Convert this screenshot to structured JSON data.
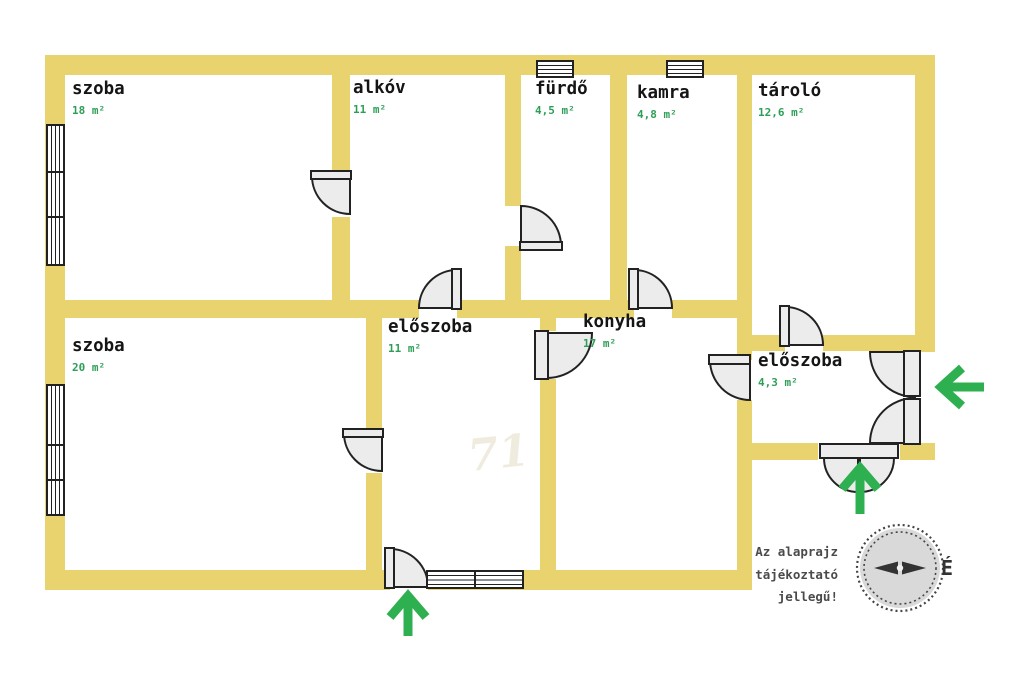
{
  "rooms": [
    {
      "name": "szoba",
      "area": "18 m²"
    },
    {
      "name": "alkóv",
      "area": "11 m²"
    },
    {
      "name": "fürdő",
      "area": "4,5 m²"
    },
    {
      "name": "kamra",
      "area": "4,8 m²"
    },
    {
      "name": "tároló",
      "area": "12,6 m²"
    },
    {
      "name": "szoba",
      "area": "20 m²"
    },
    {
      "name": "előszoba",
      "area": "11 m²"
    },
    {
      "name": "konyha",
      "area": "17 m²"
    },
    {
      "name": "előszoba",
      "area": "4,3 m²"
    }
  ],
  "disclaimer": {
    "lines": [
      "Az alaprajz",
      "tájékoztató",
      "jellegű!"
    ]
  },
  "compass": {
    "north_label": "É"
  },
  "watermark": {
    "text": "71"
  },
  "colors": {
    "wall": "#e9d36e",
    "room_area_text": "#2e9e57",
    "entrance_arrow": "#2eb050",
    "door_fill": "#ececec",
    "door_stroke": "#222222",
    "compass_fill": "#d9d9d9",
    "disclaimer_text": "#4a4a4a"
  }
}
